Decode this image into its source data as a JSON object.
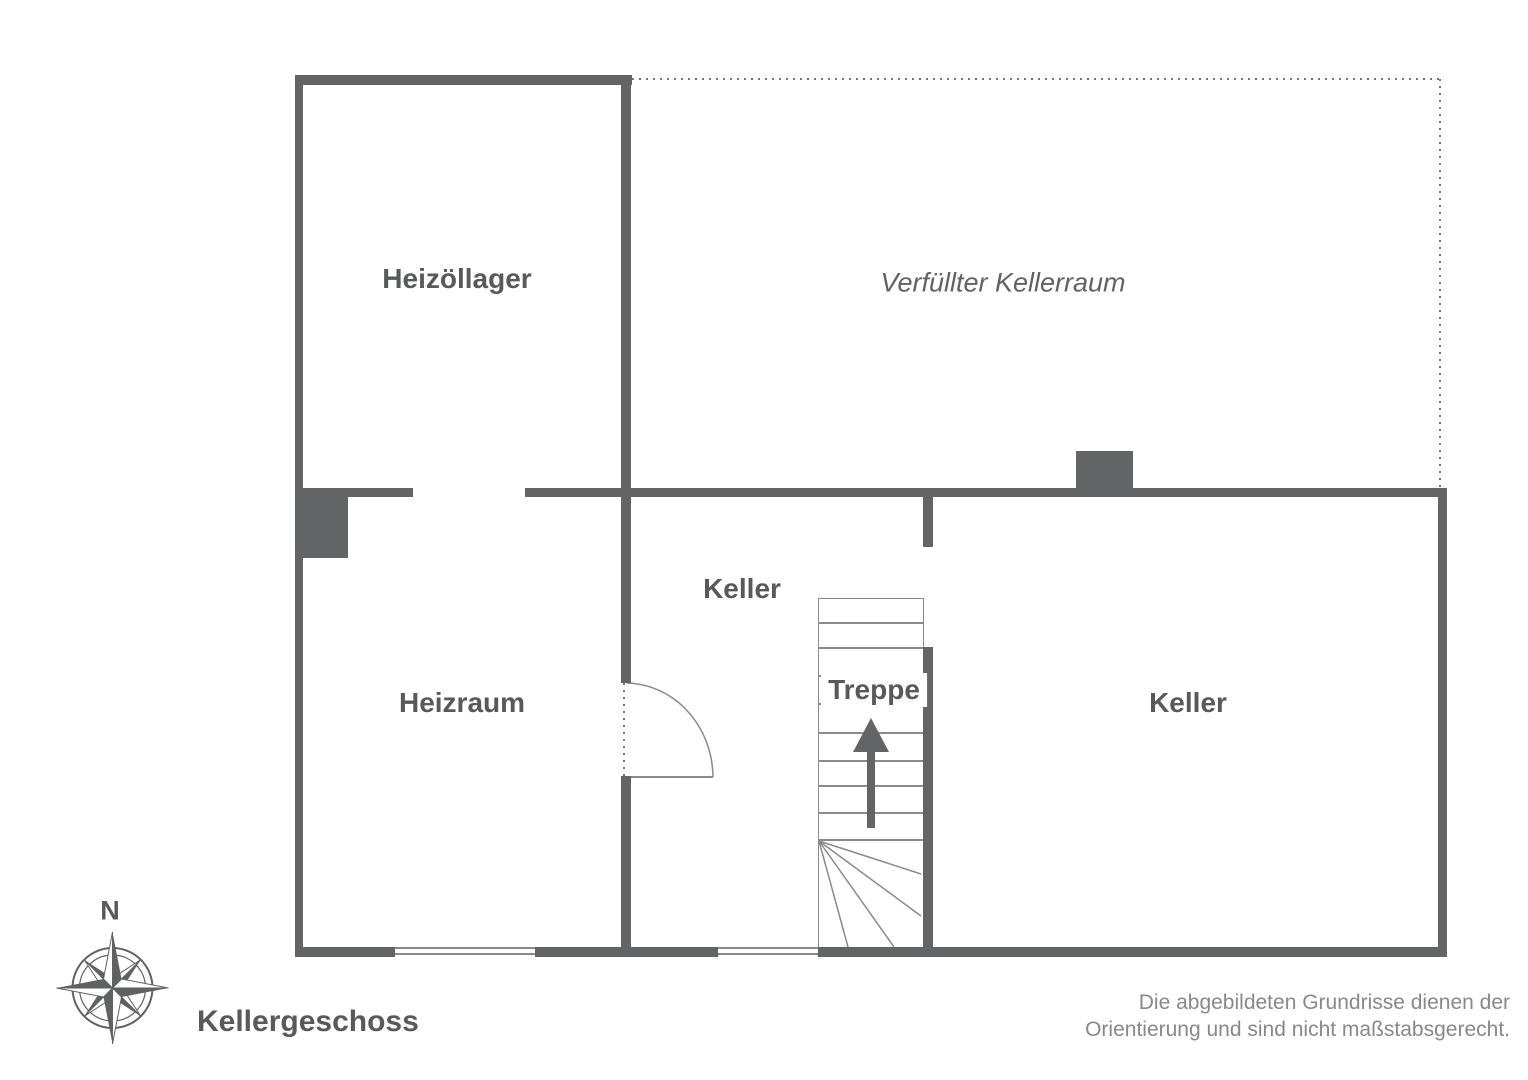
{
  "title": "Kellergeschoss",
  "rooms": {
    "heizoellager": "Heizöllager",
    "verfuellter_kellerraum": "Verfüllter Kellerraum",
    "heizraum": "Heizraum",
    "keller_mitte": "Keller",
    "treppe": "Treppe",
    "keller_rechts": "Keller"
  },
  "compass": {
    "north_label": "N"
  },
  "disclaimer": {
    "line1": "Die abgebildeten Grundrisse dienen der",
    "line2": "Orientierung und sind nicht maßstabsgerecht."
  },
  "colors": {
    "wall": "#636466",
    "room_label": "#58595b",
    "thin_line": "#8a8a8a",
    "dotted_boundary": "#777777",
    "disclaimer_text": "#87888a"
  }
}
